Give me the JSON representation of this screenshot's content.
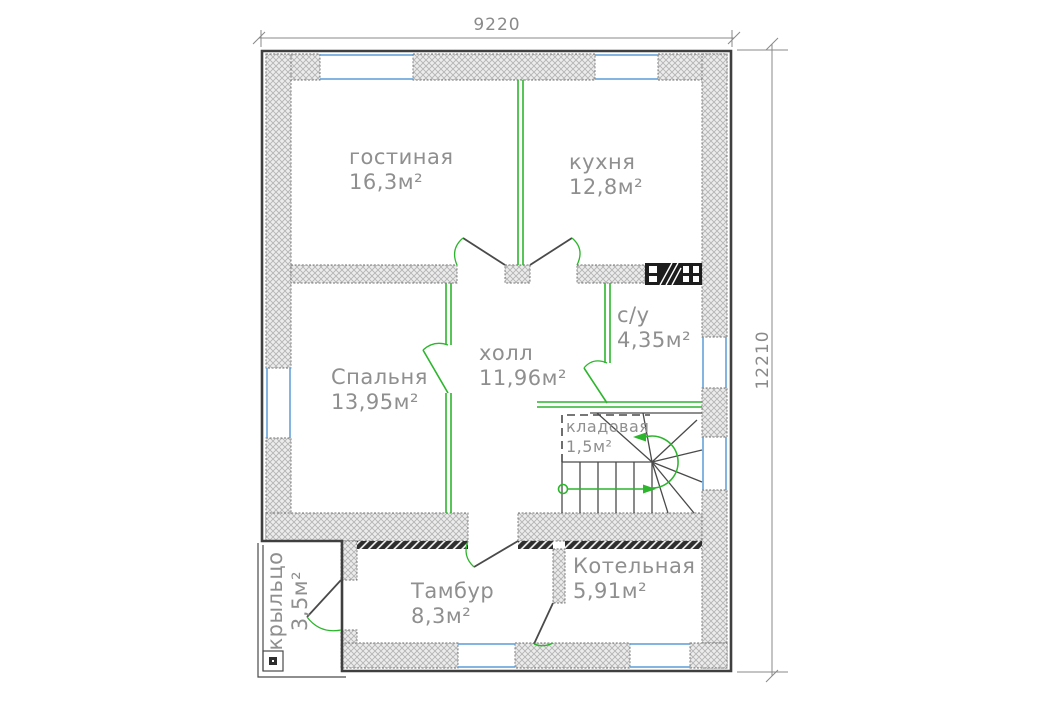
{
  "plan": {
    "type": "floor-plan-drawing",
    "dimensions": {
      "width_mm": "9220",
      "height_mm": "12210"
    },
    "rooms": {
      "living": {
        "label": "гостиная",
        "area": "16,3м²"
      },
      "kitchen": {
        "label": "кухня",
        "area": "12,8м²"
      },
      "bathroom": {
        "label": "с/у",
        "area": "4,35м²"
      },
      "bedroom": {
        "label": "Спальня",
        "area": "13,95м²"
      },
      "hall": {
        "label": "холл",
        "area": "11,96м²"
      },
      "storage": {
        "label": "кладовая",
        "area": "1,5м²"
      },
      "boiler": {
        "label": "Котельная",
        "area": "5,91м²"
      },
      "vestibule": {
        "label": "Тамбур",
        "area": "8,3м²"
      },
      "porch": {
        "label": "крыльцо",
        "area": "3,5м²"
      }
    },
    "colors": {
      "wall_outline": "#3f3f3f",
      "wall_hatch": "#b4b4b4",
      "partition_green": "#2db52d",
      "window_blue": "#5b9bd5",
      "label_gray": "#8f8f8f",
      "dimension_gray": "#8a8a8a"
    }
  }
}
